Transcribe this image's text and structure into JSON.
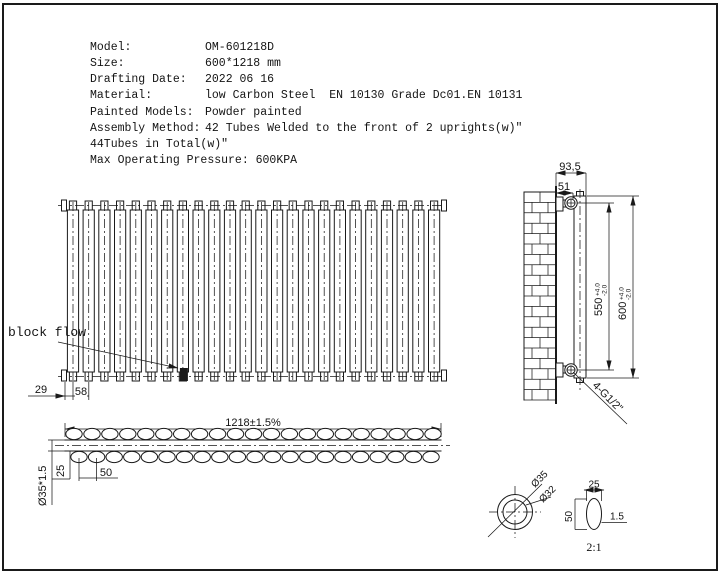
{
  "drawing": {
    "spec_table": {
      "rows": [
        {
          "label": "Model:",
          "value": "OM-601218D"
        },
        {
          "label": "Size:",
          "value": "600*1218 mm"
        },
        {
          "label": "Drafting Date:",
          "value": "2022 06 16"
        },
        {
          "label": "Material:",
          "value": "low Carbon Steel  EN 10130 Grade Dc01.EN 10131"
        },
        {
          "label": "Painted Models:",
          "value": "Powder painted"
        },
        {
          "label": "Assembly Method:",
          "value": "42 Tubes Welded to the front of 2 uprights(w)\""
        },
        {
          "label": "44Tubes in Total(w)\"",
          "value": ""
        },
        {
          "label": "Max Operating Pressure: 600KPA",
          "value": ""
        }
      ]
    },
    "front_view": {
      "block_flow_label": "block flow",
      "dim_left_offset": "29",
      "dim_pitch": "58"
    },
    "top_view": {
      "dim_width": "1218±1.5%",
      "dim_tube": "Ø35*1.5",
      "dim_row_offset": "25",
      "dim_oval_pitch": "50"
    },
    "side_view": {
      "dim_depth": "93,5",
      "dim_bracket": "51",
      "dim_bracket_span": "550",
      "dim_bracket_span_plus": "+4.0",
      "dim_bracket_span_minus": "-2.0",
      "dim_height": "600",
      "dim_height_plus": "+4.0",
      "dim_height_minus": "-2.0",
      "fitting": "4-G1/2\""
    },
    "details": {
      "dia_outer": "Ø35",
      "dia_inner": "Ø32",
      "oval_height": "50",
      "oval_width": "25",
      "wall_thickness": "1.5",
      "scale": "2:1"
    },
    "geometry": {
      "front_tube_count": 24,
      "top_oval_count": 21,
      "bottom_oval_count": 21,
      "brick_rows": 20,
      "ink": "#1a1a1a"
    }
  }
}
